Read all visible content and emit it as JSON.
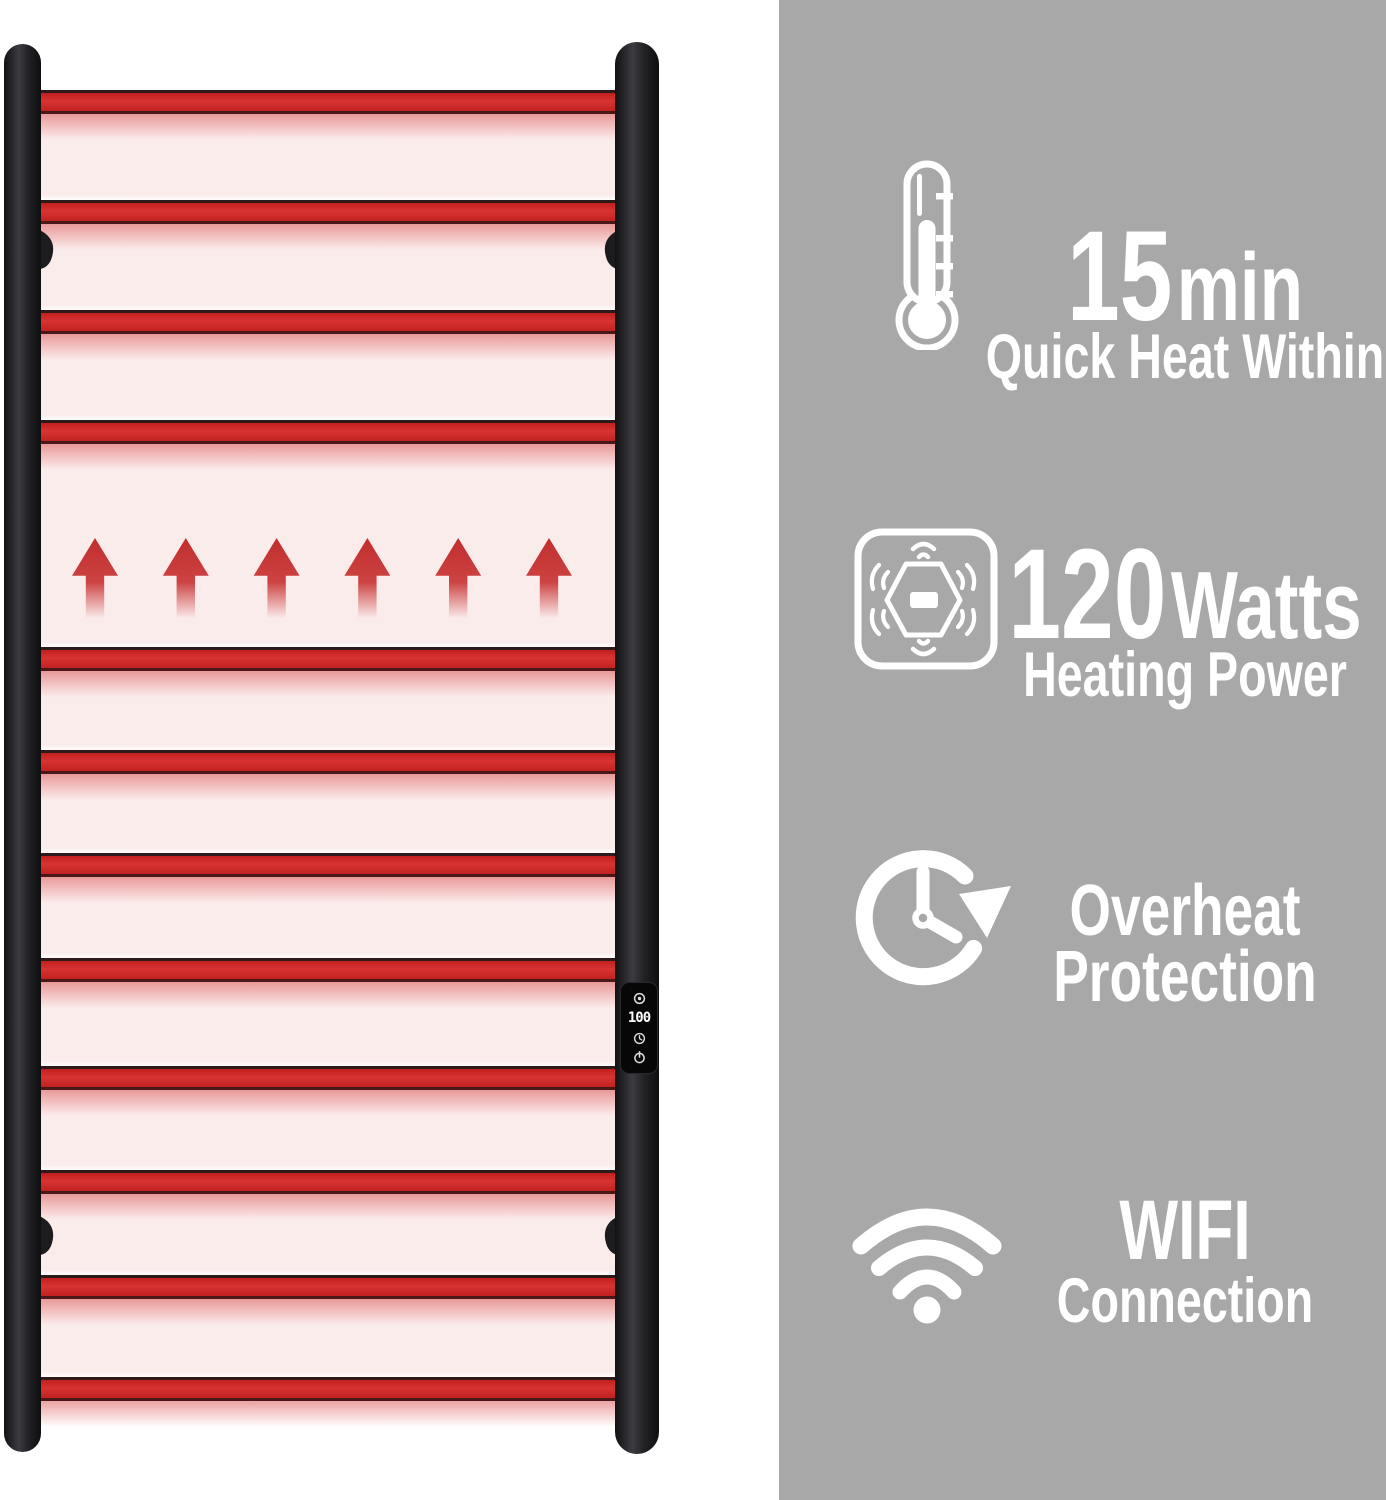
{
  "page": {
    "background_color": "#ffffff",
    "panel_background_color": "#a8a8a8",
    "text_color": "#ffffff"
  },
  "product": {
    "kind": "wall-mounted heated towel rail illustration",
    "rail_color": "#cd2828",
    "frame_color": "#232327",
    "glow_color": "#fbecec",
    "rung_count": 12,
    "heat_arrow_count": 6,
    "control_panel": {
      "display_value": "100",
      "icons": [
        "thermostat-dial-icon",
        "timer-clock-icon",
        "power-icon"
      ]
    }
  },
  "features": [
    {
      "icon": "thermometer-icon",
      "value": "15",
      "unit": "min",
      "caption": "Quick Heat Within"
    },
    {
      "icon": "heating-power-icon",
      "value": "120",
      "unit": "Watts",
      "caption": "Heating Power"
    },
    {
      "icon": "overheat-protection-clock-icon",
      "line1": "Overheat",
      "line2": "Protection"
    },
    {
      "icon": "wifi-icon",
      "line1": "WIFI",
      "line2": "Connection"
    }
  ]
}
